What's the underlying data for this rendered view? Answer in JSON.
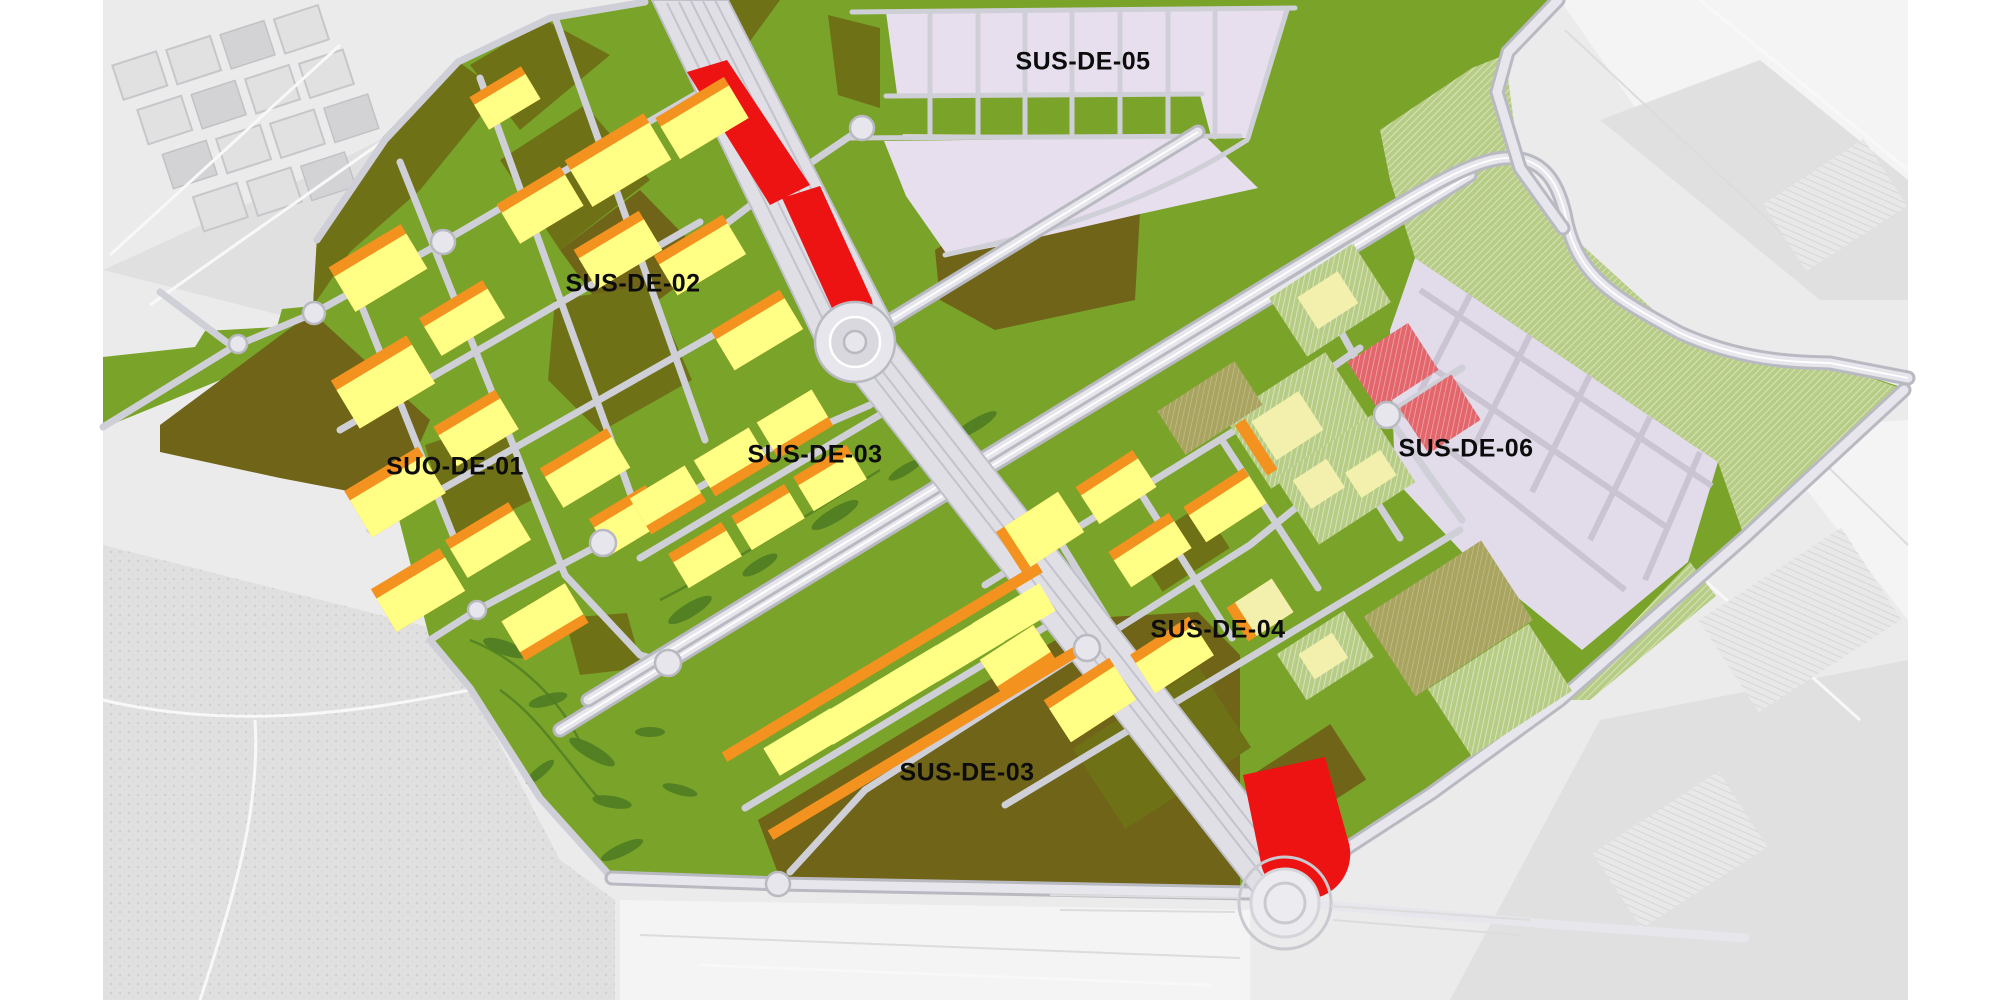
{
  "page": {
    "title": "Land-use zoning plan over grayscale aerial photograph",
    "background_color": "#ffffff"
  },
  "map": {
    "description": "Colour-coded urban development sectors drawn over a grey aerial photo, with road network, rail corridor and roundabouts",
    "labels": [
      {
        "id": "sus-de-05",
        "text": "SUS-DE-05"
      },
      {
        "id": "sus-de-02",
        "text": "SUS-DE-02"
      },
      {
        "id": "suo-de-01",
        "text": "SUO-DE-01"
      },
      {
        "id": "sus-de-03-central",
        "text": "SUS-DE-03"
      },
      {
        "id": "sus-de-06",
        "text": "SUS-DE-06"
      },
      {
        "id": "sus-de-04",
        "text": "SUS-DE-04"
      },
      {
        "id": "sus-de-03-south",
        "text": "SUS-DE-03"
      }
    ],
    "palette": {
      "open_space_green": "#7aa32a",
      "dark_olive_parcel": "#6f7116",
      "brown_olive_parcel": "#6f6418",
      "yellow_residential": "#ffff86",
      "cream_residential": "#f2f0ac",
      "orange_residential_edge": "#f3921e",
      "red_tertiary_parcel": "#ee1313",
      "red_hatched_parcel": "#e2666c",
      "pink_sector": "#e8dfee",
      "lavender_industrial_grid": "#e2dbe9",
      "hatched_green_space": "#b7cd86",
      "khaki_hatched_parcel": "#a9a45f",
      "road_fill": "#e6e6ec",
      "road_casing": "#b9b9c2",
      "aerial_ground": "#ebebeb",
      "label_text": "#0c0c0c"
    }
  }
}
